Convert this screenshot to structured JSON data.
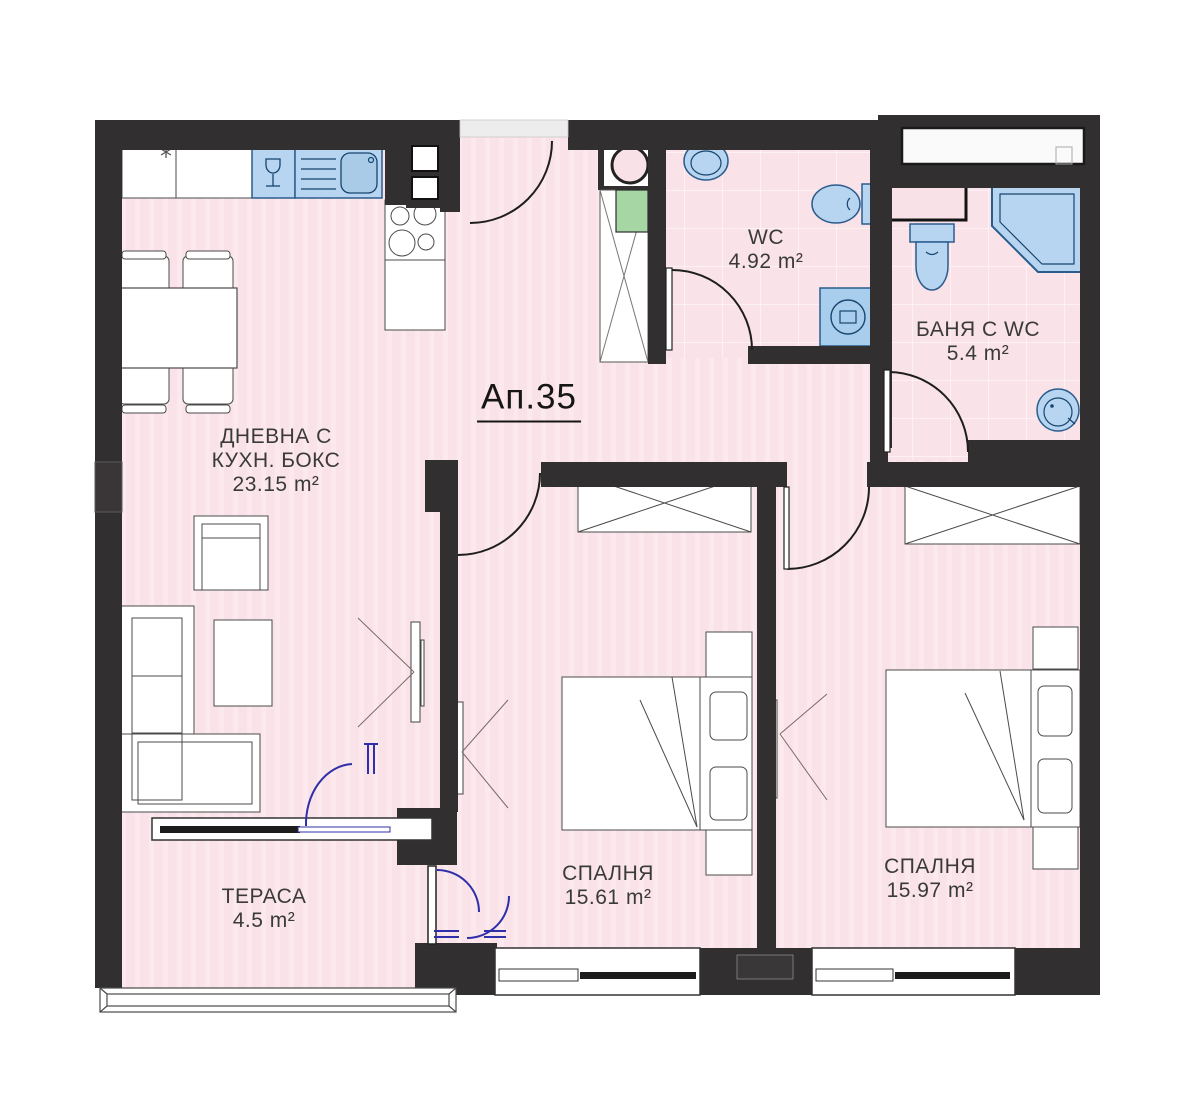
{
  "apartment": {
    "title": "Ап.35",
    "area_unit": "m²",
    "rooms": {
      "living": {
        "name_line1": "ДНЕВНА С",
        "name_line2": "КУХН. БОКС",
        "area": "23.15 m²"
      },
      "wc": {
        "name": "WC",
        "area": "4.92 m²"
      },
      "bathroom": {
        "name": "БАНЯ С WC",
        "area": "5.4 m²"
      },
      "bedroom1": {
        "name": "СПАЛНЯ",
        "area": "15.61 m²"
      },
      "bedroom2": {
        "name": "СПАЛНЯ",
        "area": "15.97 m²"
      },
      "terrace": {
        "name": "ТЕРАСА",
        "area": "4.5 m²"
      }
    },
    "colors": {
      "floor_pink": "#f9e3e8",
      "wall_dark": "#322f30",
      "fixture_blue_fill": "#b7d4f0",
      "fixture_blue_stroke": "#2b5d8c",
      "accent_green": "#a5d6a4",
      "door_swing_blue": "#2f2faa",
      "furniture_stroke": "#4b4b4b"
    }
  }
}
